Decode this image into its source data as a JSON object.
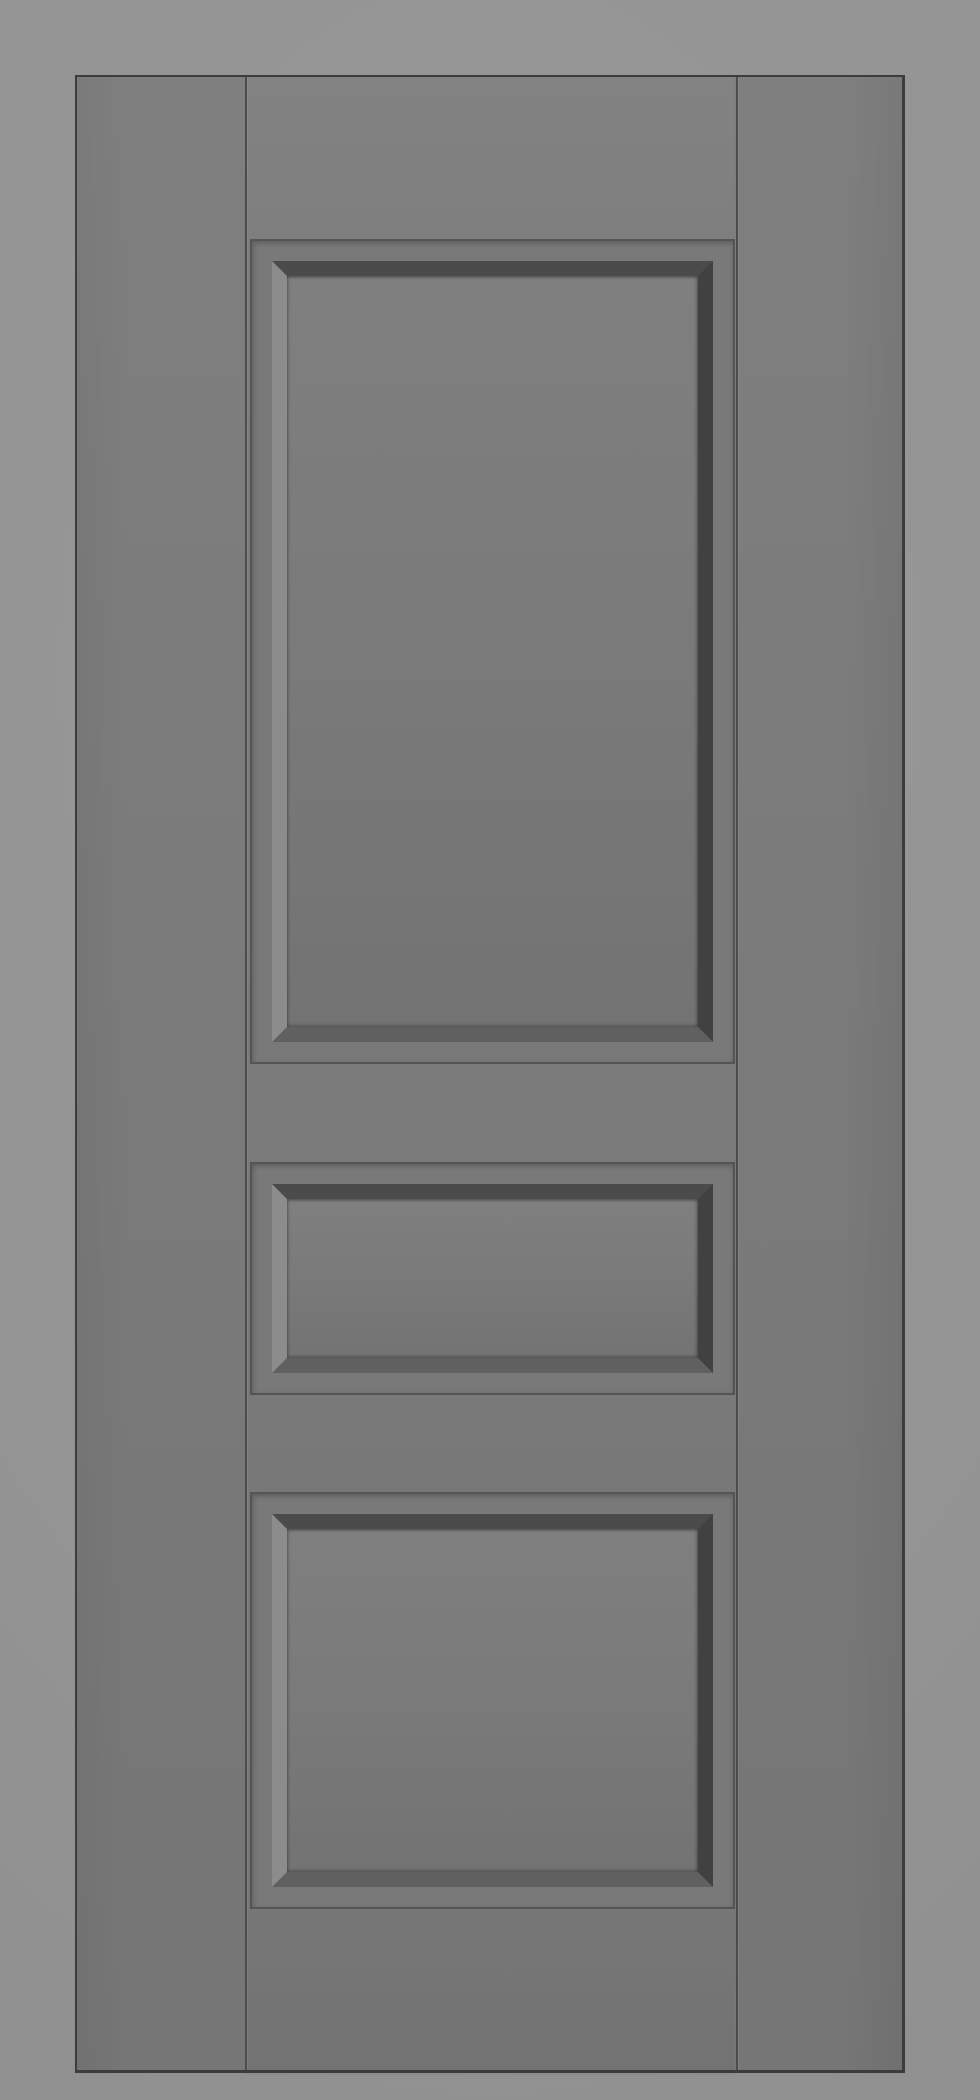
{
  "scene": {
    "description": "3D product render of a gray three-panel interior door, front elevation view, no handle or hinges, centered on a plain light gray background",
    "object": "door",
    "style": "raised panel door slab",
    "panel_count": 3
  },
  "door": {
    "label": "gray panel door",
    "parts": {
      "left_stile": "left stile",
      "right_stile": "right stile",
      "top_rail": "top rail",
      "lock_rail": "middle rail between top and middle panels",
      "intermediate_rail": "rail between middle and bottom panels",
      "bottom_rail": "bottom rail"
    },
    "panels": [
      {
        "label": "top panel",
        "position": "top",
        "size": "large tall rectangle"
      },
      {
        "label": "middle panel",
        "position": "middle",
        "size": "small short rectangle"
      },
      {
        "label": "bottom panel",
        "position": "bottom",
        "size": "medium rectangle"
      }
    ]
  },
  "colors": {
    "background": "#949494",
    "background_light": "#989898",
    "background_dark": "#8e8e8e",
    "door_face": "#7b7b7b",
    "door_edge": "#3c3c3c",
    "margin": "#797979",
    "groove": "#545454",
    "seam": "#4c4c4c",
    "bevel_light": "#8c8c8c",
    "bevel_mid": "#606060",
    "bevel_dark": "#4b4b4b",
    "bevel_shadow": "#414141",
    "panel_face": "#7a7a7a",
    "panel_face_light": "#7f7f7f",
    "panel_face_dark": "#737373"
  }
}
